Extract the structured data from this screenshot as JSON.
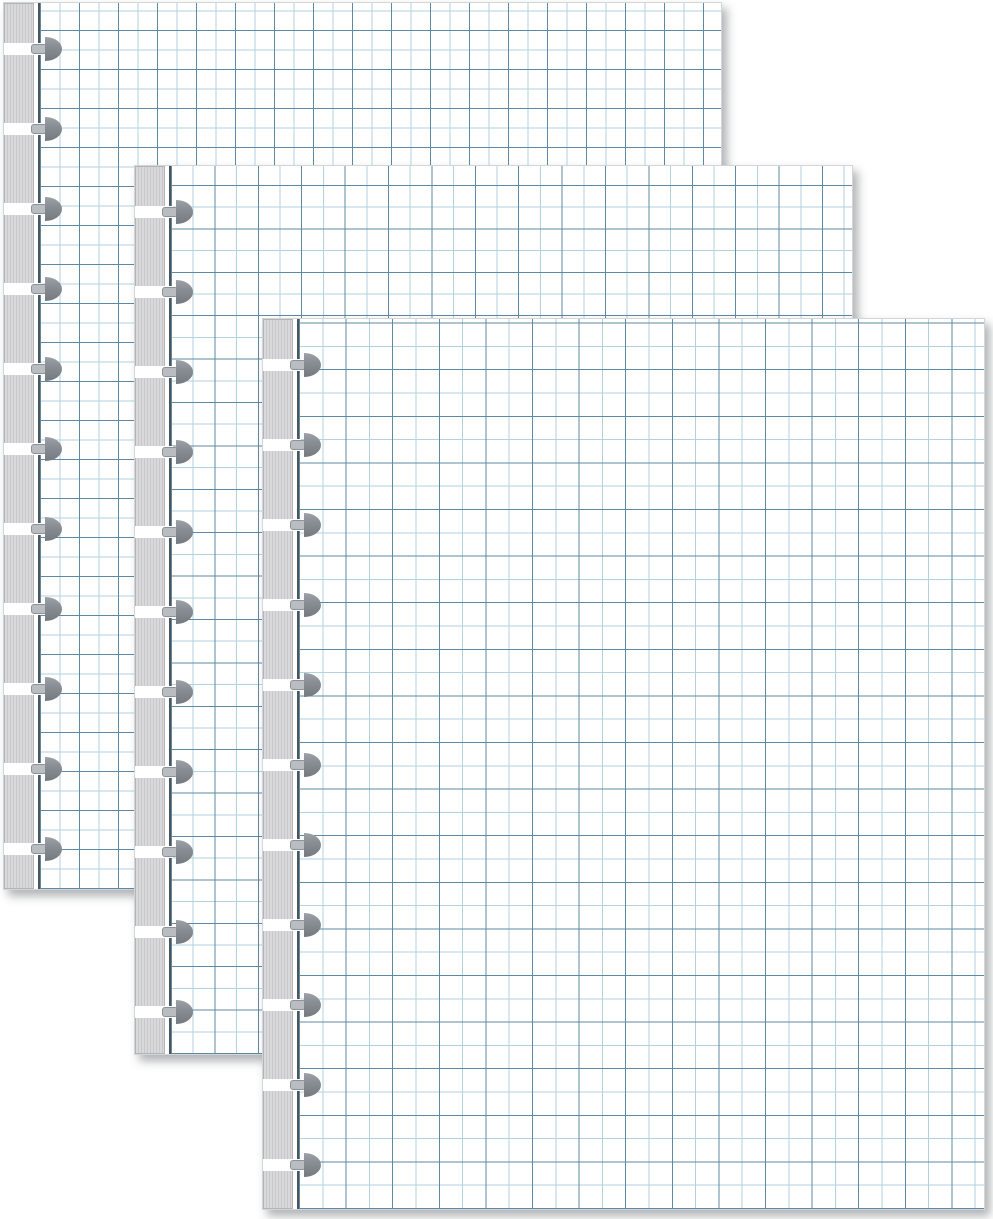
{
  "scene": {
    "description": "Product photo of three overlapping disc-bound graph paper refill sheets, each with a gray striped binding edge and eleven mushroom-shaped disc-punch slots along the left side",
    "background_color": "#ffffff",
    "canvas_width_px": 993,
    "canvas_height_px": 1219,
    "text_content": "none"
  },
  "sheets": [
    {
      "id": "back",
      "label": "back graph sheet",
      "x": 3,
      "y": 2,
      "width": 719,
      "height": 888,
      "grid_cell_px": 19.5
    },
    {
      "id": "middle",
      "label": "middle graph sheet",
      "x": 134,
      "y": 165,
      "width": 719,
      "height": 890,
      "grid_cell_px": 21.7
    },
    {
      "id": "front",
      "label": "front graph sheet",
      "x": 262,
      "y": 318,
      "width": 723,
      "height": 892,
      "grid_cell_px": 23.3
    }
  ],
  "binding": {
    "strip_width_px": 30,
    "grid_left_offset_px": 34,
    "punch_count": 11,
    "first_punch_center_y_px": 46,
    "punch_spacing_px": 80,
    "gap_height_px": 12,
    "gap_width_px": 38,
    "stem_left_px": 27,
    "stem_width_px": 16,
    "stem_height_px": 10,
    "cap_left_px": 41,
    "cap_width_px": 17,
    "cap_height_px": 24
  },
  "colors": {
    "paper": "#ffffff",
    "grid_line_light": "#b3d2e2",
    "grid_line_dark": "#5f88a3",
    "paper_edge_line": "#4d545a",
    "strip_base": "#d9d9db",
    "strip_stripe": "#c8c8ca",
    "strip_border": "#b2b4b6",
    "punch_stem_fill": "#b9bdc1",
    "punch_stem_border": "#8d9297",
    "punch_cap_top": "#9ba1a6",
    "punch_cap_mid": "#868c91",
    "punch_cap_bottom": "#747a7f",
    "shadow": "rgba(80,84,88,0.45)"
  }
}
